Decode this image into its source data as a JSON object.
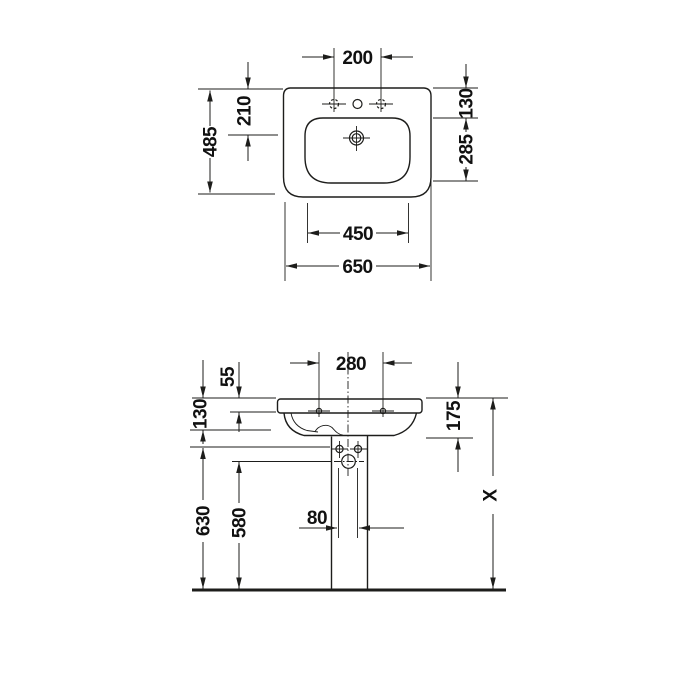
{
  "drawing_type": "washbasin technical dimension drawing",
  "colors": {
    "line": "#1d1d1b",
    "background": "#ffffff"
  },
  "plan": {
    "tap_hole_distance": "200",
    "total_depth": "485",
    "rear_to_drain": "210",
    "rear_edge_offset": "130",
    "drain_to_front": "285",
    "bowl_width": "450",
    "total_width": "650"
  },
  "elevation": {
    "fixing_hole_distance": "280",
    "rim_to_fixing_hole": "55",
    "rim_to_outlet_line": "130",
    "rim_to_trap": "175",
    "fixing_to_floor": "630",
    "outlet_to_floor": "580",
    "pipe_clearance": "80",
    "total_height": "X"
  }
}
